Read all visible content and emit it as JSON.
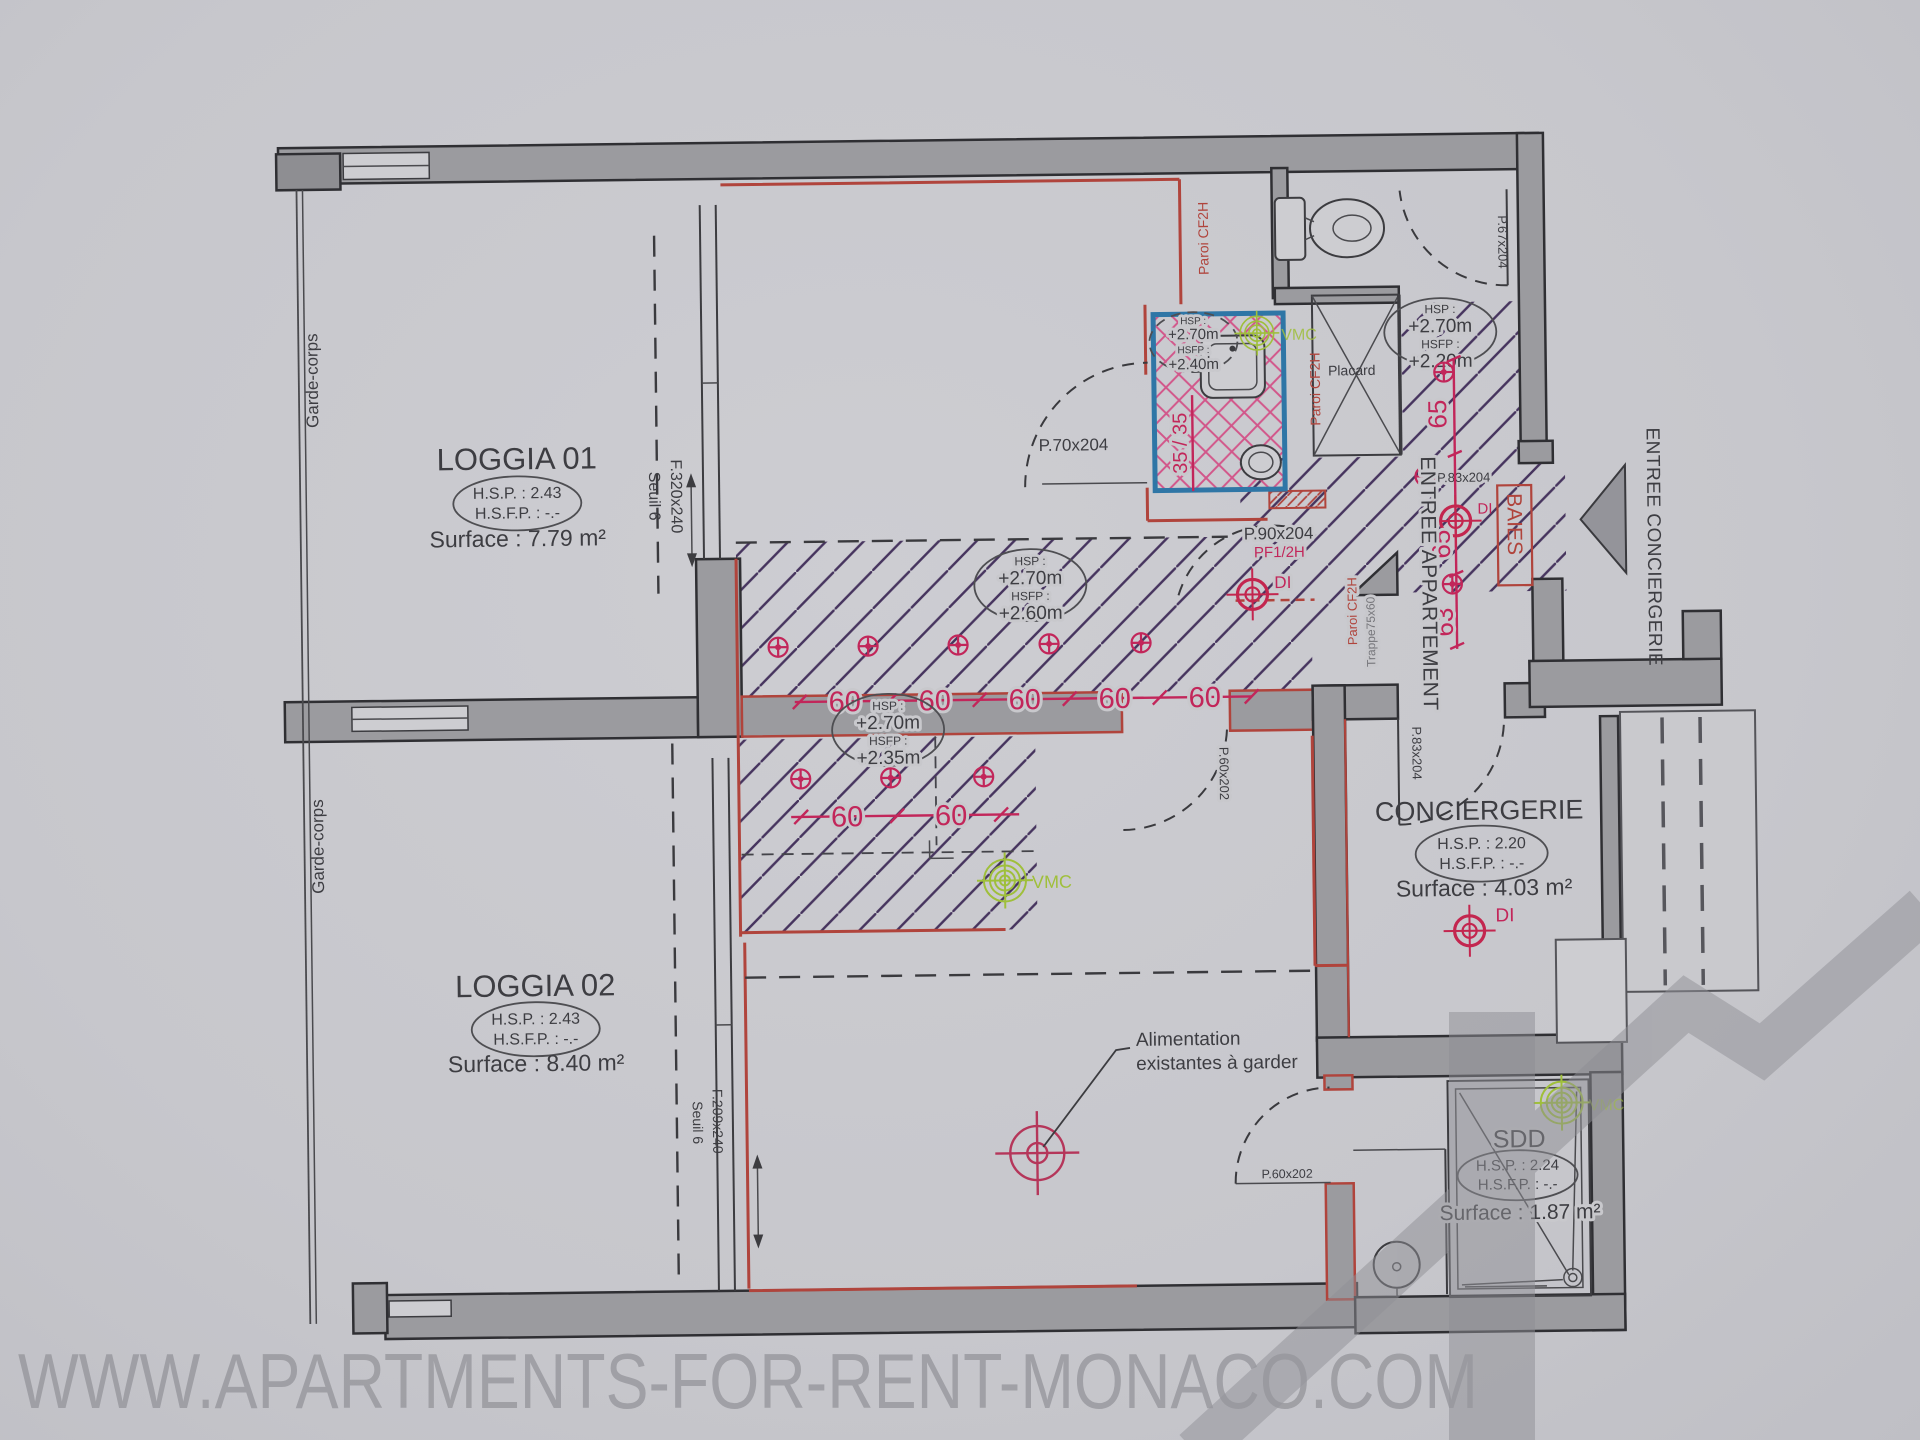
{
  "watermark": {
    "site_url": "WWW.APARTMENTS-FOR-RENT-MONACO.COM"
  },
  "rooms": {
    "loggia01": {
      "name": "LOGGIA 01",
      "hsp": "H.S.P. : 2.43",
      "hsfp": "H.S.F.P. : -.-",
      "surface": "Surface : 7.79 m²"
    },
    "loggia02": {
      "name": "LOGGIA 02",
      "hsp": "H.S.P. : 2.43",
      "hsfp": "H.S.F.P. : -.-",
      "surface": "Surface : 8.40 m²"
    },
    "conciergerie": {
      "name": "CONCIERGERIE",
      "hsp": "H.S.P. : 2.20",
      "hsfp": "H.S.F.P. : -.-",
      "surface": "Surface : 4.03 m²"
    },
    "sdd": {
      "name": "SDD",
      "hsp": "H.S.P. : 2.24",
      "hsfp": "H.S.F.P. : -.-",
      "surface": "Surface : 1.87 m²"
    }
  },
  "ceilings": {
    "hsp_label": "HSP :",
    "hsfp_label": "HSFP :",
    "corridor": {
      "hsp": "+2.70m",
      "hsfp": "+2.60m"
    },
    "living_soffit": {
      "hsp": "+2.70m",
      "hsfp": "+2.35m"
    },
    "entry": {
      "hsp": "+2.70m",
      "hsfp": "+2.20m"
    },
    "shower": {
      "hsp": "+2.70m",
      "hsfp": "+2.40m"
    }
  },
  "doors": {
    "p70": "P.70x204",
    "p90": "P.90x204",
    "p90_type": "PF1/2H",
    "p67": "P.67x204",
    "p83_conciergerie": "P.83x204",
    "p83_entry": "P.83x204",
    "p60_hall": "P.60x202",
    "p60_sdd": "P.60x202"
  },
  "windows": {
    "loggia01": {
      "ref": "F.320x240",
      "seuil": "Seuil 6"
    },
    "loggia02": {
      "ref": "F.209x240",
      "seuil": "Seuil 6"
    }
  },
  "labels": {
    "garde_corps": "Garde-corps",
    "placard": "Placard",
    "paroi_cf2h": "Paroi CF2H",
    "trappe": "Trappe75x60",
    "entree_appartement": "ENTREE APPARTEMENT",
    "entree_conciergerie": "ENTREE CONCIERGERIE",
    "baies": "BAIES",
    "vmc": "VMC",
    "di": "DI",
    "alimentation_1": "Alimentation",
    "alimentation_2": "existantes à garder"
  },
  "dims": {
    "spot_spacing": "60",
    "entry_65": "65",
    "entry_63": "63",
    "shower_35": "35 / 35"
  },
  "colors": {
    "paper": "#c8c8cc",
    "wall_gray": "#9b9b9f",
    "new_wall_red": "#b0443c",
    "dim_pink": "#c2265a",
    "hatch_navy": "#46345e",
    "shower_blue": "#2f76a6",
    "vmc_green": "#9fbf3b"
  }
}
